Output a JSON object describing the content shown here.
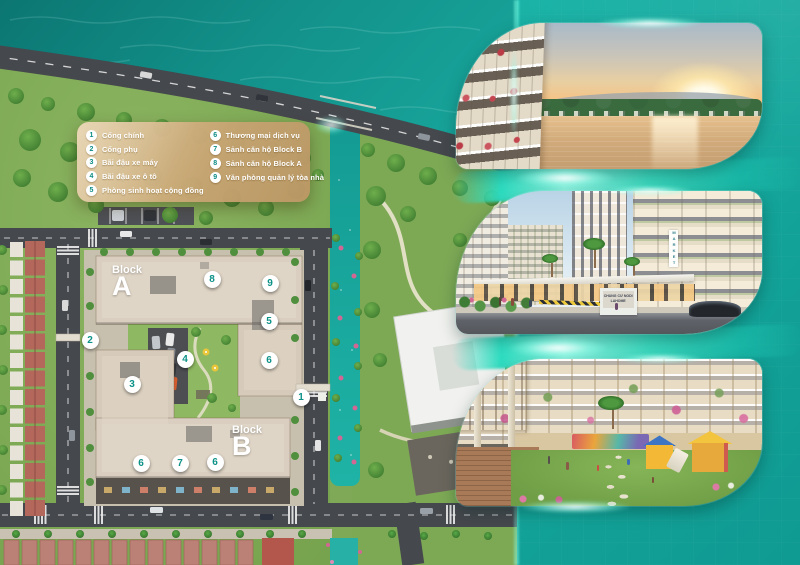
{
  "legend": {
    "left": [
      {
        "num": "1",
        "label": "Cổng chính"
      },
      {
        "num": "2",
        "label": "Cổng phụ"
      },
      {
        "num": "3",
        "label": "Bãi đậu xe máy"
      },
      {
        "num": "4",
        "label": "Bãi đậu xe ô tô"
      },
      {
        "num": "5",
        "label": "Phòng sinh hoạt cộng đồng"
      }
    ],
    "right": [
      {
        "num": "6",
        "label": "Thương mại dịch vụ"
      },
      {
        "num": "7",
        "label": "Sảnh căn hộ Block B"
      },
      {
        "num": "8",
        "label": "Sảnh căn hộ Block A"
      },
      {
        "num": "9",
        "label": "Văn phòng quản lý tòa nhà"
      }
    ]
  },
  "blocks": {
    "a_small": "Block",
    "a_big": "A",
    "b_small": "Block",
    "b_big": "B"
  },
  "markers": {
    "m1": "1",
    "m2": "2",
    "m3": "3",
    "m4": "4",
    "m5": "5",
    "m6a": "6",
    "m6b": "6",
    "m6c": "6",
    "m7": "7",
    "m8": "8",
    "m9": "9"
  },
  "photos": {
    "market_sign": "MARKET",
    "gate_sign_line1": "CHUNG CƯ NODI",
    "gate_sign_line2": "LAHOME"
  },
  "colors": {
    "teal_band": "#12a79d",
    "glow_accent": "#3fe8cf",
    "legend_gold": "#c9a06a",
    "marker_number": "#0c9187",
    "water": "#14968e"
  }
}
